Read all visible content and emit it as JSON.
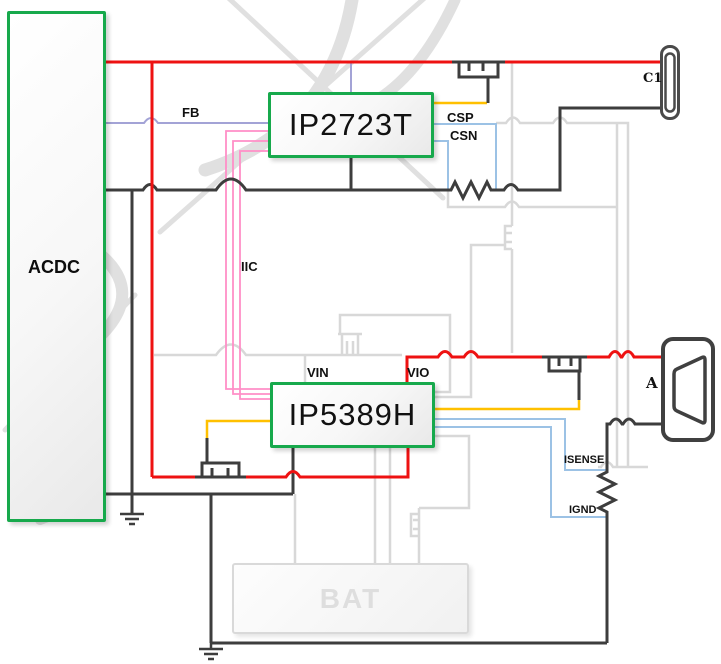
{
  "diagram": {
    "blocks": {
      "acdc": "ACDC",
      "controller_top": "IP2723T",
      "controller_bottom": "IP5389H",
      "battery": "BAT"
    },
    "connectors": {
      "type_c_port": "C1",
      "type_a_port": "A"
    },
    "net_labels": {
      "fb": "FB",
      "csp": "CSP",
      "csn": "CSN",
      "iic": "IIC",
      "vin": "VIN",
      "vio": "VIO",
      "isense": "ISENSE",
      "ignd": "IGND"
    },
    "colors": {
      "red": "#ee1111",
      "black": "#3d3d3d",
      "gray": "#d8d8d8",
      "pink": "#ff8fc7",
      "yellow": "#ffc000",
      "blue": "#9cc2e5",
      "lavender": "#a3a3d6",
      "green": "#17a94c",
      "watermark": "#c7c7c7",
      "connector": "#4a4a4a"
    }
  }
}
